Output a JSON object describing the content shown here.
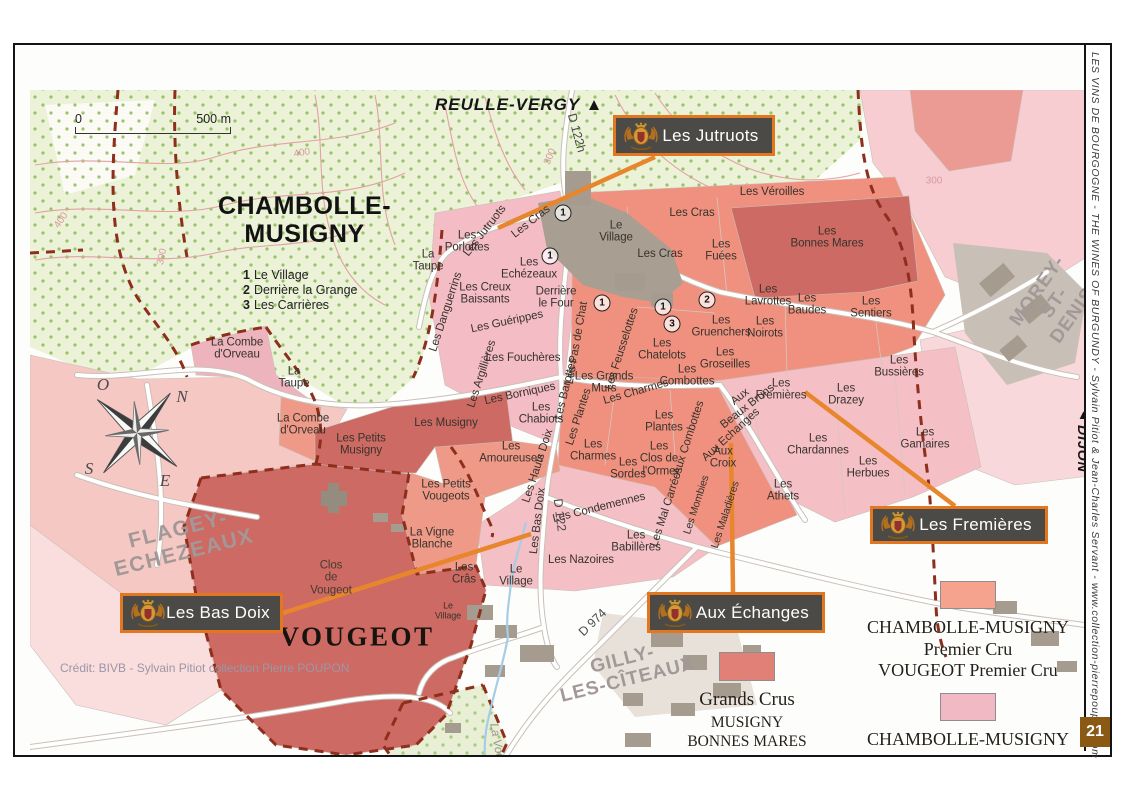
{
  "page_number": "21",
  "sidebar_text": "LES VINS DE BOURGOGNE  -  THE WINES OF BURGUNDY  -  Sylvain Pitiot & Jean-Charles Servant  -  www.collection-pierrepoupon.com",
  "credit": "Crédit: BIVB - Sylvain Pitiot collection Pierre POUPON",
  "scale": {
    "zero": "0",
    "end": "500 m"
  },
  "title": {
    "line1": "CHAMBOLLE-",
    "line2": "MUSIGNY",
    "notes": [
      {
        "num": "1",
        "label": "Le Village"
      },
      {
        "num": "2",
        "label": "Derrière la Grange"
      },
      {
        "num": "3",
        "label": "Les Carrières"
      }
    ]
  },
  "directions": {
    "reulle": "REULLE-VERGY ▲",
    "beaune": "◀ BEAUNE",
    "citeaux": "▼ CITEAUX",
    "dijon_arrow": "▲",
    "dijon": "DIJON"
  },
  "legend": {
    "grands_crus": {
      "title": "Grands Crus",
      "lines": [
        "MUSIGNY",
        "BONNES MARES",
        "CLOS DE VOUGEOT"
      ]
    },
    "premier_cru": {
      "lines": [
        "CHAMBOLLE-MUSIGNY",
        "Premier Cru",
        "VOUGEOT Premier Cru"
      ]
    },
    "village": {
      "lines": [
        "CHAMBOLLE-MUSIGNY",
        "VOUGEOT"
      ]
    }
  },
  "colors": {
    "grand_cru": "#cd6a63",
    "premier_cru": "#f0917f",
    "village": "#f3bac3",
    "legend_gc": "#e08077",
    "legend_pc": "#f5a28f",
    "legend_v": "#f0b9c4",
    "orange": "#e8862d",
    "callout_bg": "#4b4a46",
    "callout_border": "#e2771f",
    "page_box": "#8a5a14"
  },
  "callouts": [
    {
      "id": "les-jutruots",
      "label": "Les Jutruots",
      "x": 598,
      "y": 70,
      "w": 162,
      "h": 41,
      "line": [
        640,
        112,
        483,
        183
      ]
    },
    {
      "id": "les-fremieres",
      "label": "Les Fremières",
      "x": 855,
      "y": 461,
      "w": 178,
      "h": 38,
      "line": [
        940,
        461,
        790,
        347
      ]
    },
    {
      "id": "aux-echanges",
      "label": "Aux Échanges",
      "x": 632,
      "y": 547,
      "w": 178,
      "h": 41,
      "line": [
        718,
        547,
        716,
        398
      ]
    },
    {
      "id": "les-bas-doix",
      "label": "Les Bas Doix",
      "x": 105,
      "y": 548,
      "w": 163,
      "h": 40,
      "line": [
        268,
        568,
        516,
        489
      ]
    }
  ],
  "circled_numbers": [
    {
      "n": "1",
      "x": 548,
      "y": 168
    },
    {
      "n": "1",
      "x": 535,
      "y": 211
    },
    {
      "n": "1",
      "x": 587,
      "y": 258
    },
    {
      "n": "1",
      "x": 648,
      "y": 262
    },
    {
      "n": "2",
      "x": 692,
      "y": 255
    },
    {
      "n": "3",
      "x": 657,
      "y": 279
    }
  ],
  "compass_letters": [
    {
      "t": "N",
      "x": 167,
      "y": 352
    },
    {
      "t": "O",
      "x": 88,
      "y": 340
    },
    {
      "t": "S",
      "x": 74,
      "y": 424
    },
    {
      "t": "E",
      "x": 150,
      "y": 436
    }
  ],
  "map_labels": [
    {
      "t": "Les\nPorlottes",
      "x": 452,
      "y": 197
    },
    {
      "t": "Les Jutruots",
      "x": 470,
      "y": 186,
      "r": -52
    },
    {
      "t": "Les Cras",
      "x": 516,
      "y": 177,
      "r": -38
    },
    {
      "t": "Le\nVillage",
      "x": 601,
      "y": 187
    },
    {
      "t": "Les Cras",
      "x": 677,
      "y": 168
    },
    {
      "t": "Les Véroilles",
      "x": 757,
      "y": 147
    },
    {
      "t": "Les\nBonnes Mares",
      "x": 812,
      "y": 193
    },
    {
      "t": "Les\nFuées",
      "x": 706,
      "y": 206
    },
    {
      "t": "Les Cras",
      "x": 645,
      "y": 209
    },
    {
      "t": "La\nTaupe",
      "x": 413,
      "y": 216
    },
    {
      "t": "Les\nEchézeaux",
      "x": 514,
      "y": 224
    },
    {
      "t": "Les Creux\nBaissants",
      "x": 470,
      "y": 249
    },
    {
      "t": "Derrière\nle Four",
      "x": 541,
      "y": 253
    },
    {
      "t": "Les Danguerrins",
      "x": 431,
      "y": 267,
      "r": -72
    },
    {
      "t": "Les Guérippes",
      "x": 492,
      "y": 277,
      "r": -12
    },
    {
      "t": "Les Argillières",
      "x": 467,
      "y": 329,
      "r": -72
    },
    {
      "t": "Les Fouchères",
      "x": 508,
      "y": 313
    },
    {
      "t": "Les Borniques",
      "x": 505,
      "y": 349,
      "r": -12
    },
    {
      "t": "Les\nChabiots",
      "x": 526,
      "y": 369
    },
    {
      "t": "Les Pas de Chat",
      "x": 562,
      "y": 298,
      "r": -80
    },
    {
      "t": "Les Barottes",
      "x": 551,
      "y": 344,
      "r": -76
    },
    {
      "t": "Les Plantes",
      "x": 564,
      "y": 372,
      "r": -72
    },
    {
      "t": "Les Grands\nMurs",
      "x": 589,
      "y": 338
    },
    {
      "t": "Les Feusselottes",
      "x": 607,
      "y": 304,
      "r": -72
    },
    {
      "t": "Les Charmes",
      "x": 621,
      "y": 347,
      "r": -16
    },
    {
      "t": "Les\nChatelots",
      "x": 647,
      "y": 305
    },
    {
      "t": "Les\nCombottes",
      "x": 672,
      "y": 331
    },
    {
      "t": "Les\nGruenchers",
      "x": 706,
      "y": 282
    },
    {
      "t": "Les\nGroseilles",
      "x": 710,
      "y": 314
    },
    {
      "t": "Les\nLavrottes",
      "x": 753,
      "y": 251
    },
    {
      "t": "Les\nBaudes",
      "x": 792,
      "y": 260
    },
    {
      "t": "Les\nNoirots",
      "x": 750,
      "y": 283
    },
    {
      "t": "Les\nSentiers",
      "x": 856,
      "y": 263
    },
    {
      "t": "Les\nBussières",
      "x": 884,
      "y": 322
    },
    {
      "t": "Les\nFremières",
      "x": 766,
      "y": 345
    },
    {
      "t": "Les\nDrazey",
      "x": 831,
      "y": 350
    },
    {
      "t": "Aux\nBeaux Bruns",
      "x": 729,
      "y": 357,
      "r": -38
    },
    {
      "t": "Aux Echanges",
      "x": 716,
      "y": 390,
      "r": -42
    },
    {
      "t": "Aux\nCroix",
      "x": 708,
      "y": 413
    },
    {
      "t": "Les\nChardannes",
      "x": 803,
      "y": 400
    },
    {
      "t": "Les\nHerbues",
      "x": 853,
      "y": 423
    },
    {
      "t": "Les\nGamaires",
      "x": 910,
      "y": 394
    },
    {
      "t": "Les\nAthets",
      "x": 768,
      "y": 446
    },
    {
      "t": "Les Musigny",
      "x": 431,
      "y": 378
    },
    {
      "t": "Les Petits\nMusigny",
      "x": 346,
      "y": 400
    },
    {
      "t": "Les\nAmoureuses",
      "x": 496,
      "y": 408
    },
    {
      "t": "Les Hauts Doix",
      "x": 523,
      "y": 421,
      "r": -72
    },
    {
      "t": "Les Bas Doix",
      "x": 523,
      "y": 476,
      "r": -83
    },
    {
      "t": "Les Petits\nVougeots",
      "x": 431,
      "y": 446
    },
    {
      "t": "La Vigne\nBlanche",
      "x": 417,
      "y": 494
    },
    {
      "t": "Les\nCrâs",
      "x": 449,
      "y": 529
    },
    {
      "t": "Le\nVillage",
      "x": 501,
      "y": 531
    },
    {
      "t": "Le\nVillage",
      "x": 433,
      "y": 566,
      "s": 9
    },
    {
      "t": "Les\nCharmes",
      "x": 578,
      "y": 406
    },
    {
      "t": "Les\nSordes",
      "x": 613,
      "y": 424
    },
    {
      "t": "Les\nPlantes",
      "x": 649,
      "y": 377
    },
    {
      "t": "Les\nClos de\nl'Orme",
      "x": 644,
      "y": 414
    },
    {
      "t": "Aux Combottes",
      "x": 674,
      "y": 393,
      "r": -72
    },
    {
      "t": "Les Condemennes",
      "x": 584,
      "y": 463,
      "r": -14
    },
    {
      "t": "Les Nazoires",
      "x": 566,
      "y": 515
    },
    {
      "t": "Les\nBabillères",
      "x": 621,
      "y": 497
    },
    {
      "t": "Les Mal Carrées",
      "x": 652,
      "y": 462,
      "r": -72
    },
    {
      "t": "Les Mombies",
      "x": 682,
      "y": 460,
      "r": -72,
      "s": 10.5
    },
    {
      "t": "Les Maladières",
      "x": 711,
      "y": 470,
      "r": -72,
      "s": 10.5
    },
    {
      "t": "La Combe\nd'Orveau",
      "x": 222,
      "y": 304
    },
    {
      "t": "La\nTaupe",
      "x": 279,
      "y": 333
    },
    {
      "t": "La Combe\nd'Orveau",
      "x": 288,
      "y": 380
    },
    {
      "t": "Clos\nde\nVougeot",
      "x": 316,
      "y": 533,
      "c": "dark"
    },
    {
      "t": "400",
      "x": 287,
      "y": 109,
      "r": -10,
      "c": "contour"
    },
    {
      "t": "400",
      "x": 47,
      "y": 176,
      "r": -55,
      "c": "contour"
    },
    {
      "t": "300",
      "x": 148,
      "y": 212,
      "r": -78,
      "c": "contour"
    },
    {
      "t": "300",
      "x": 536,
      "y": 112,
      "r": -68,
      "c": "contour"
    },
    {
      "t": "300",
      "x": 919,
      "y": 137,
      "r": 0,
      "c": "contour"
    },
    {
      "t": "D 122h",
      "x": 561,
      "y": 88,
      "r": 75,
      "c": "road"
    },
    {
      "t": "D 122",
      "x": 544,
      "y": 470,
      "r": 83,
      "c": "road"
    },
    {
      "t": "D 974",
      "x": 578,
      "y": 578,
      "r": -44,
      "c": "road"
    },
    {
      "t": "La Vouge",
      "x": 483,
      "y": 703,
      "r": 80,
      "c": "river"
    },
    {
      "t": "FLAGEY-\nECHEZEAUX",
      "x": 166,
      "y": 496,
      "r": -14,
      "c": "town"
    },
    {
      "t": "GILLY-\nLES-CÎTEAUX",
      "x": 610,
      "y": 625,
      "r": -14,
      "c": "town2"
    },
    {
      "t": "MOREY-\nST-DENIS",
      "x": 1040,
      "y": 258,
      "r": -55,
      "c": "town2"
    },
    {
      "t": "VOUGEOT",
      "x": 342,
      "y": 592,
      "c": "big"
    }
  ]
}
